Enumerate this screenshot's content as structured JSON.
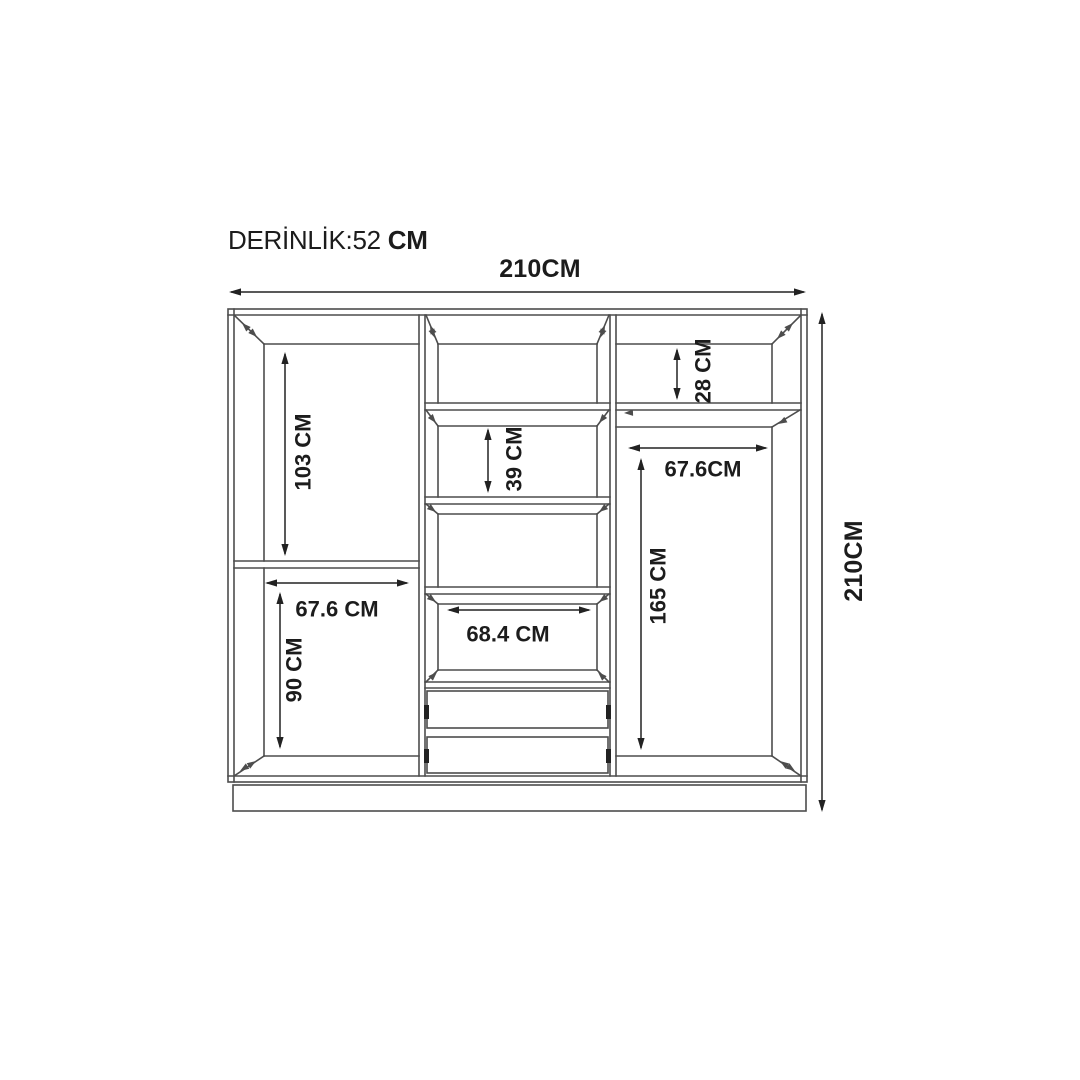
{
  "title": {
    "label": "DERİNLİK:52",
    "unit": "CM"
  },
  "dimensions": {
    "overall_width": "210CM",
    "overall_height": "210CM",
    "left_upper_height": "103 CM",
    "left_shelf_width": "67.6 CM",
    "left_lower_height": "90 CM",
    "middle_shelf_height": "39 CM",
    "middle_shelf_width": "68.4 CM",
    "right_upper_height": "28 CM",
    "right_shelf_width": "67.6CM",
    "right_lower_height": "165 CM"
  },
  "colors": {
    "line": "#4d4d4d",
    "dimension": "#222222",
    "text": "#1c1c1c",
    "background": "#ffffff"
  }
}
